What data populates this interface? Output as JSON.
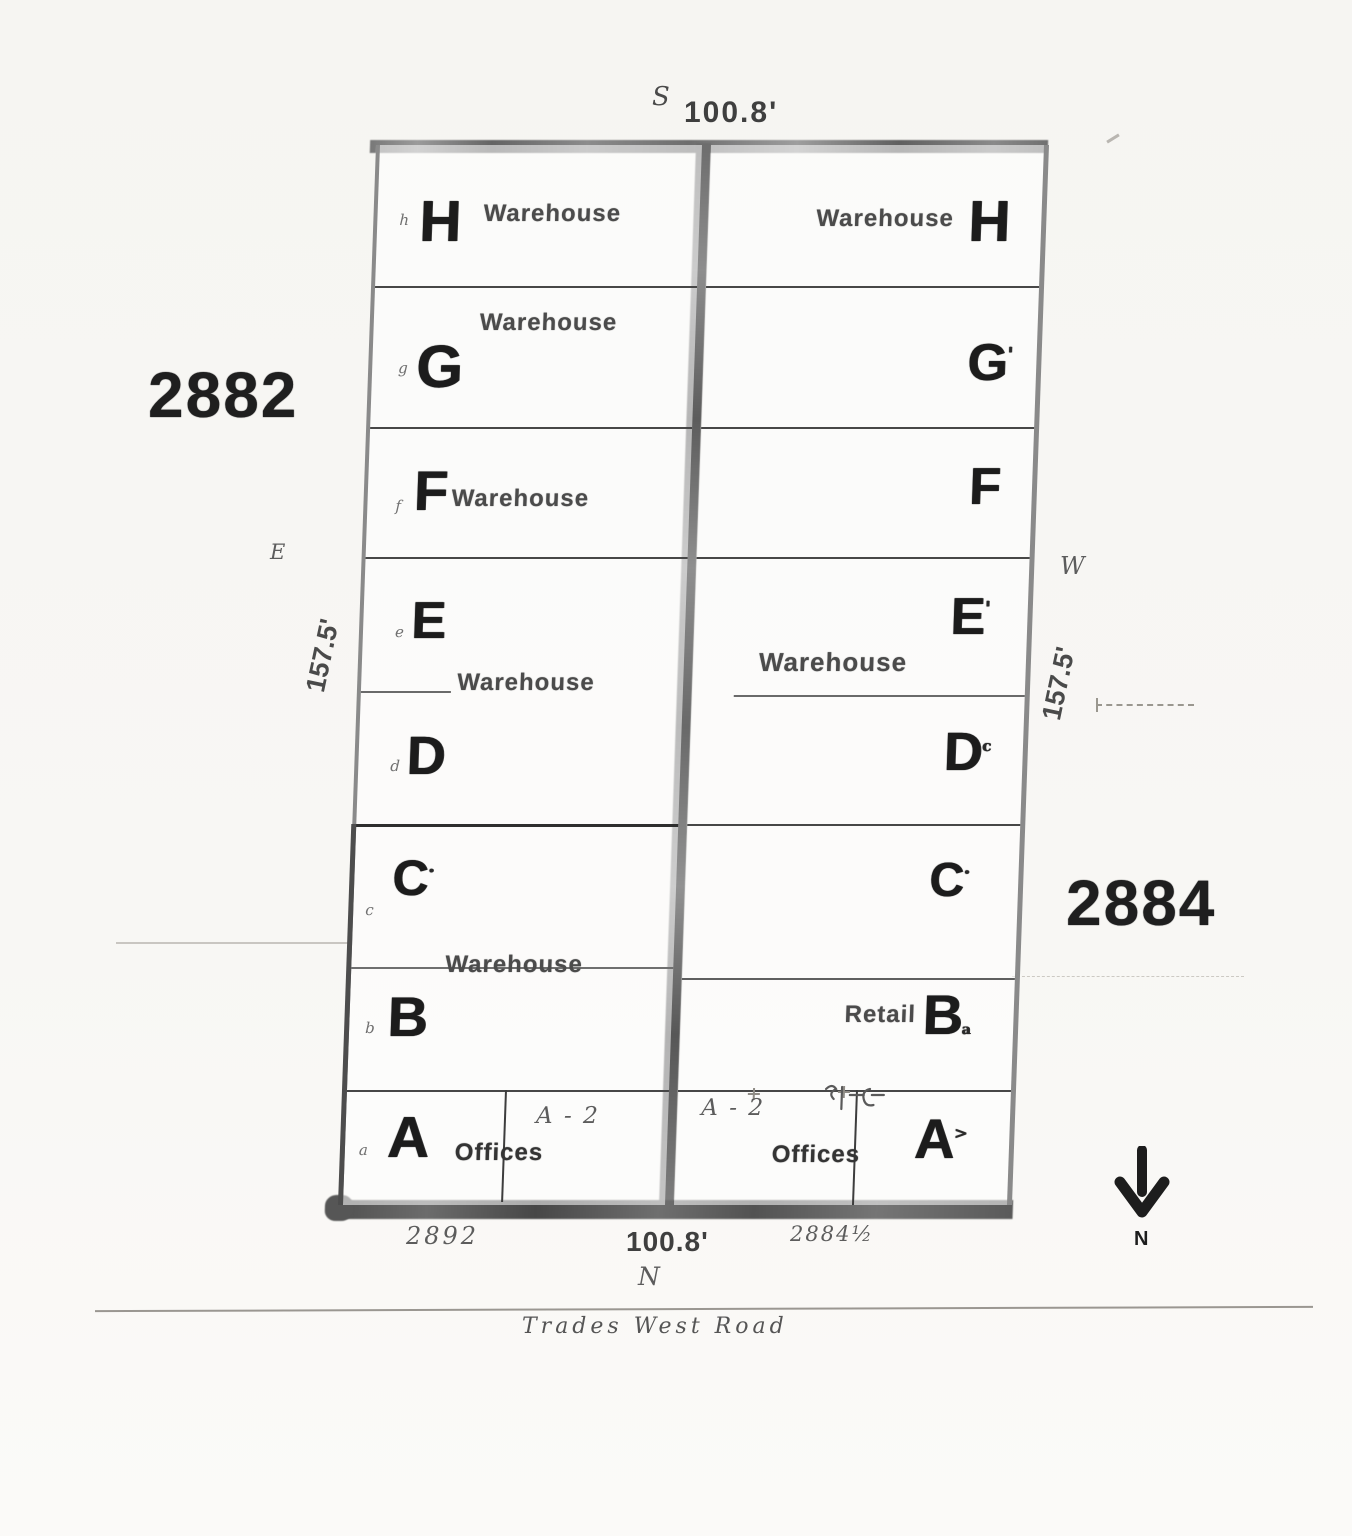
{
  "plan": {
    "top_edge": {
      "direction": "S",
      "dimension": "100.8'"
    },
    "bottom_edge": {
      "direction": "N",
      "dimension": "100.8'",
      "address_left": "2892",
      "address_right": "2884½"
    },
    "road_name": "Trades West Road",
    "north_arrow_label": "N",
    "left_building": {
      "number": "2882",
      "side": {
        "direction": "E",
        "dimension": "157.5'"
      },
      "ed_shared_use": "Warehouse",
      "cb_shared_use": "Warehouse",
      "rows": [
        {
          "small": "h",
          "letter": "H",
          "use": "Warehouse"
        },
        {
          "small": "g",
          "letter": "G",
          "use": "Warehouse"
        },
        {
          "small": "f",
          "letter": "F",
          "use": "Warehouse"
        },
        {
          "small": "e",
          "letter": "E"
        },
        {
          "small": "d",
          "letter": "D"
        },
        {
          "small": "c",
          "letter": "C",
          "mark": "·"
        },
        {
          "small": "b",
          "letter": "B"
        },
        {
          "small": "a",
          "letter": "A",
          "use": "Offices",
          "note": "A - 2"
        }
      ]
    },
    "right_building": {
      "number": "2884",
      "side": {
        "direction": "W",
        "dimension": "157.5'"
      },
      "ed_shared_use": "Warehouse",
      "rows": [
        {
          "letter": "H",
          "use": "Warehouse"
        },
        {
          "letter": "G",
          "mark": "'"
        },
        {
          "letter": "F"
        },
        {
          "letter": "E",
          "mark": "'"
        },
        {
          "letter": "D",
          "mark": "c"
        },
        {
          "letter": "C",
          "mark": "·"
        },
        {
          "letter": "B",
          "use": "Retail",
          "mark": "a"
        },
        {
          "letter": "A",
          "use": "Offices",
          "note": "A - 2",
          "mark": ">"
        }
      ]
    }
  }
}
